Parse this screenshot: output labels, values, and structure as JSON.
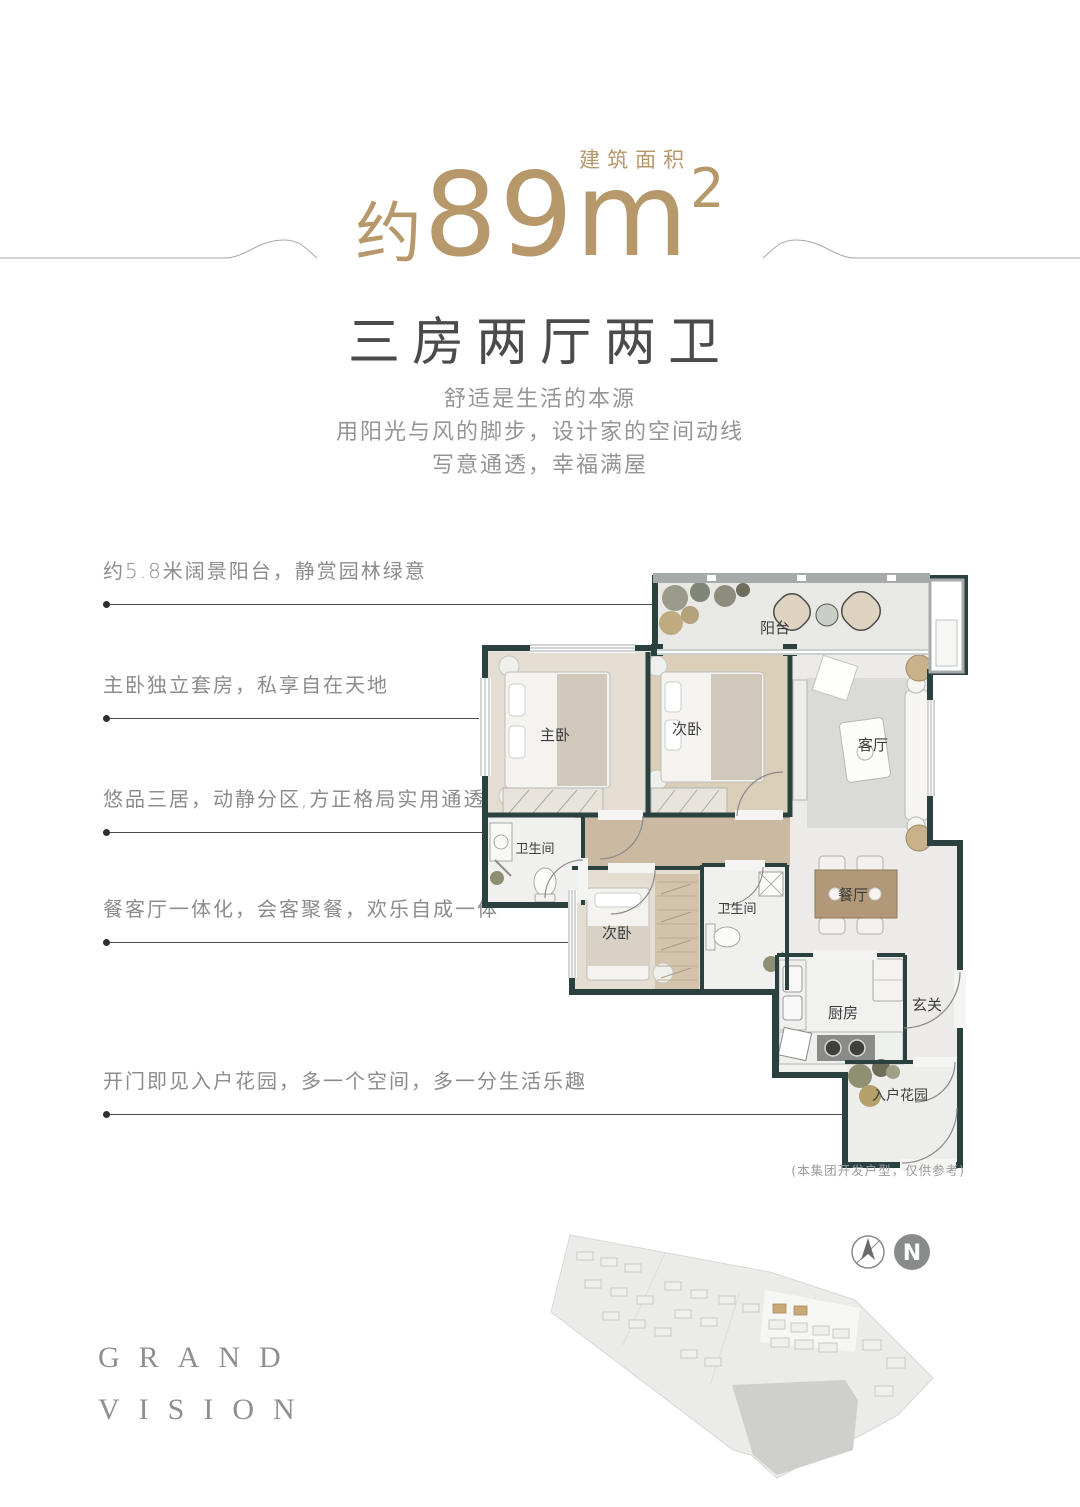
{
  "header": {
    "area_approx": "约",
    "area_value": "89",
    "area_unit": "m",
    "area_sup": "2",
    "area_label": "建筑面积",
    "accent_color": "#b6986b",
    "title": "三房两厅两卫",
    "desc_lines": [
      "舒适是生活的本源",
      "用阳光与风的脚步，设计家的空间动线",
      "写意通透，幸福满屋"
    ]
  },
  "callouts": [
    {
      "text": "约5.8米阔景阳台，静赏园林绿意"
    },
    {
      "text": "主卧独立套房，私享自在天地"
    },
    {
      "text": "悠品三居，动静分区,方正格局实用通透"
    },
    {
      "text": "餐客厅一体化，会客聚餐，欢乐自成一体"
    },
    {
      "text": "开门即见入户花园，多一个空间，多一分生活乐趣"
    }
  ],
  "floorplan": {
    "rooms": {
      "balcony": "阳台",
      "master": "主卧",
      "bedroom2": "次卧",
      "living": "客厅",
      "bath1": "卫生间",
      "bedroom3": "次卧",
      "bath2": "卫生间",
      "dining": "餐厅",
      "kitchen": "厨房",
      "foyer": "玄关",
      "garden": "入户花园"
    },
    "wall_color": "#2b4140",
    "note": "(本集团开发户型，仅供参考)"
  },
  "footer": {
    "brand_top": "GRAND",
    "brand_bottom": "VISION",
    "north_label": "N"
  }
}
